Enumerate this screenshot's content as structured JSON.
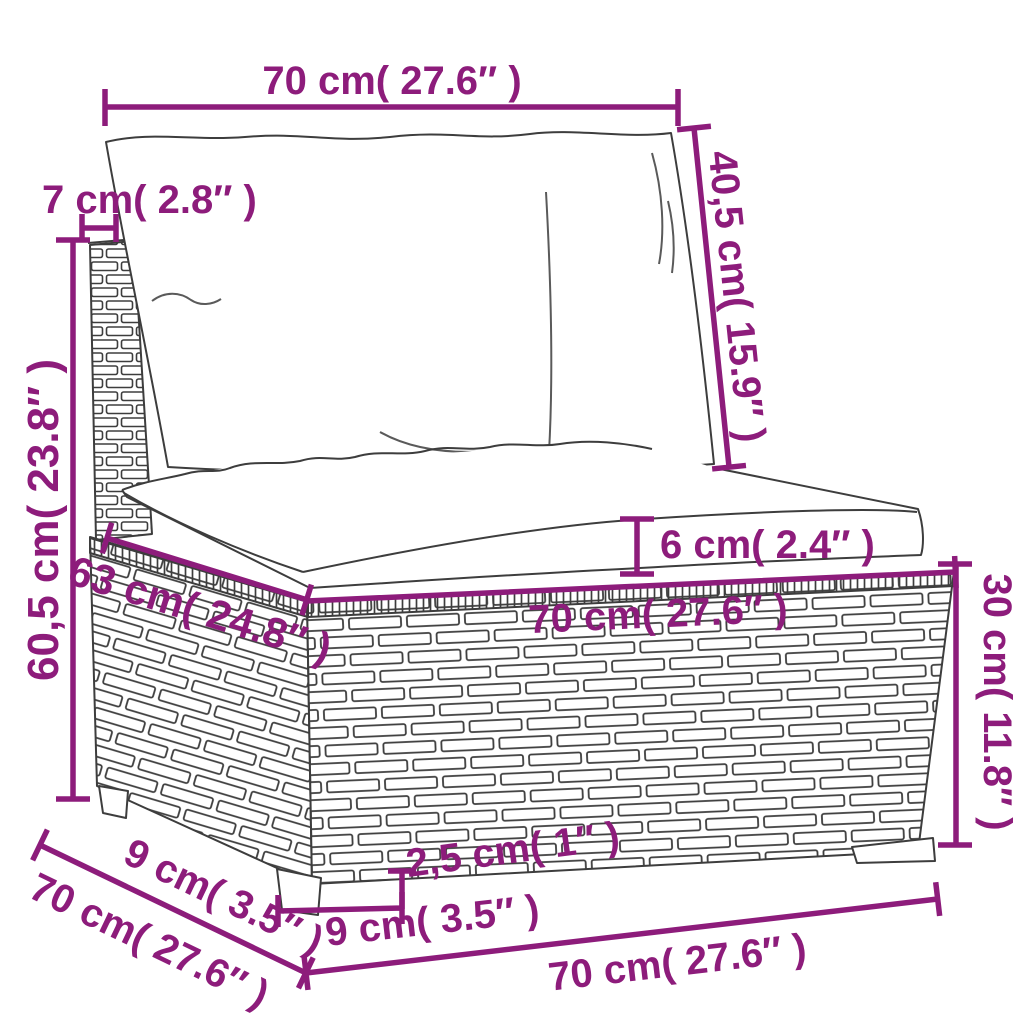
{
  "diagram": {
    "subject": "rattan middle sofa section with back cushion, seat cushion, wicker base and feet",
    "colors": {
      "dimension": "#8d1c7b",
      "line_art": "#3d3d3d",
      "background": "#ffffff"
    },
    "dims": {
      "top_width": {
        "label": "70 cm( 27.6″ )"
      },
      "backrest_thickness": {
        "label": "7 cm( 2.8″ )"
      },
      "back_cushion_height": {
        "label": "40,5 cm( 15.9″ )"
      },
      "total_height": {
        "label": "60,5 cm( 23.8″ )"
      },
      "cushion_thickness": {
        "label": "6 cm( 2.4″ )"
      },
      "seat_depth": {
        "label": "63 cm( 24.8″ )"
      },
      "seat_width": {
        "label": "70 cm( 27.6″ )"
      },
      "base_height": {
        "label": "30 cm( 11.8″ )"
      },
      "side_foot_offset": {
        "label": "9 cm( 3.5″ )"
      },
      "side_depth": {
        "label": "70 cm( 27.6″ )"
      },
      "foot_height": {
        "label": "2,5 cm( 1″ )"
      },
      "front_foot_offset": {
        "label": "9 cm( 3.5″ )"
      },
      "base_width": {
        "label": "70 cm( 27.6″ )"
      }
    }
  }
}
